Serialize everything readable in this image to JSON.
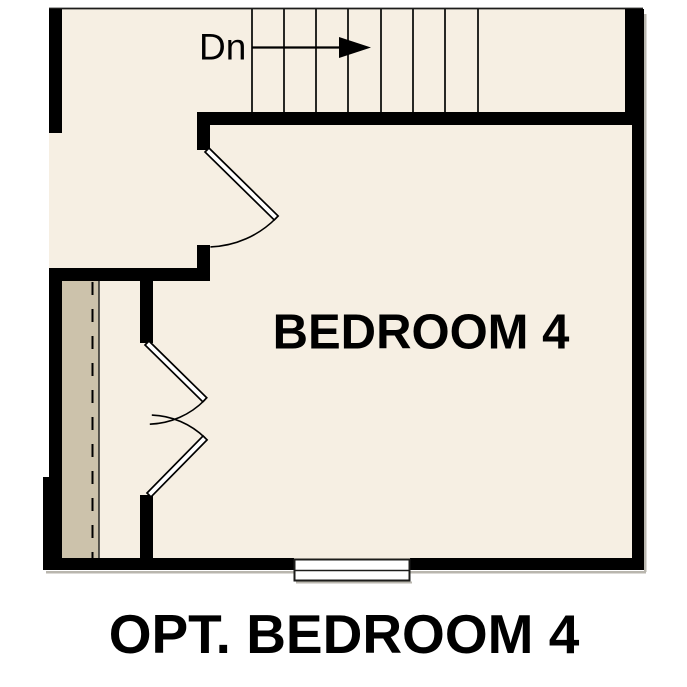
{
  "plan": {
    "caption": "OPT. BEDROOM 4",
    "room_label": "BEDROOM 4",
    "colors": {
      "floor": "#f6efe3",
      "attic_strip": "#ccc2ab",
      "wall": "#000000",
      "line": "#1d1d1b",
      "door_leaf": "#ffffff",
      "window_fill": "#ffffff",
      "shadow": "#b9b6ae"
    },
    "stairs": {
      "label": "Dn",
      "direction": "right",
      "tread_count": 8,
      "tread_xs": [
        252,
        284,
        316,
        348,
        381,
        413,
        445,
        478
      ]
    }
  }
}
